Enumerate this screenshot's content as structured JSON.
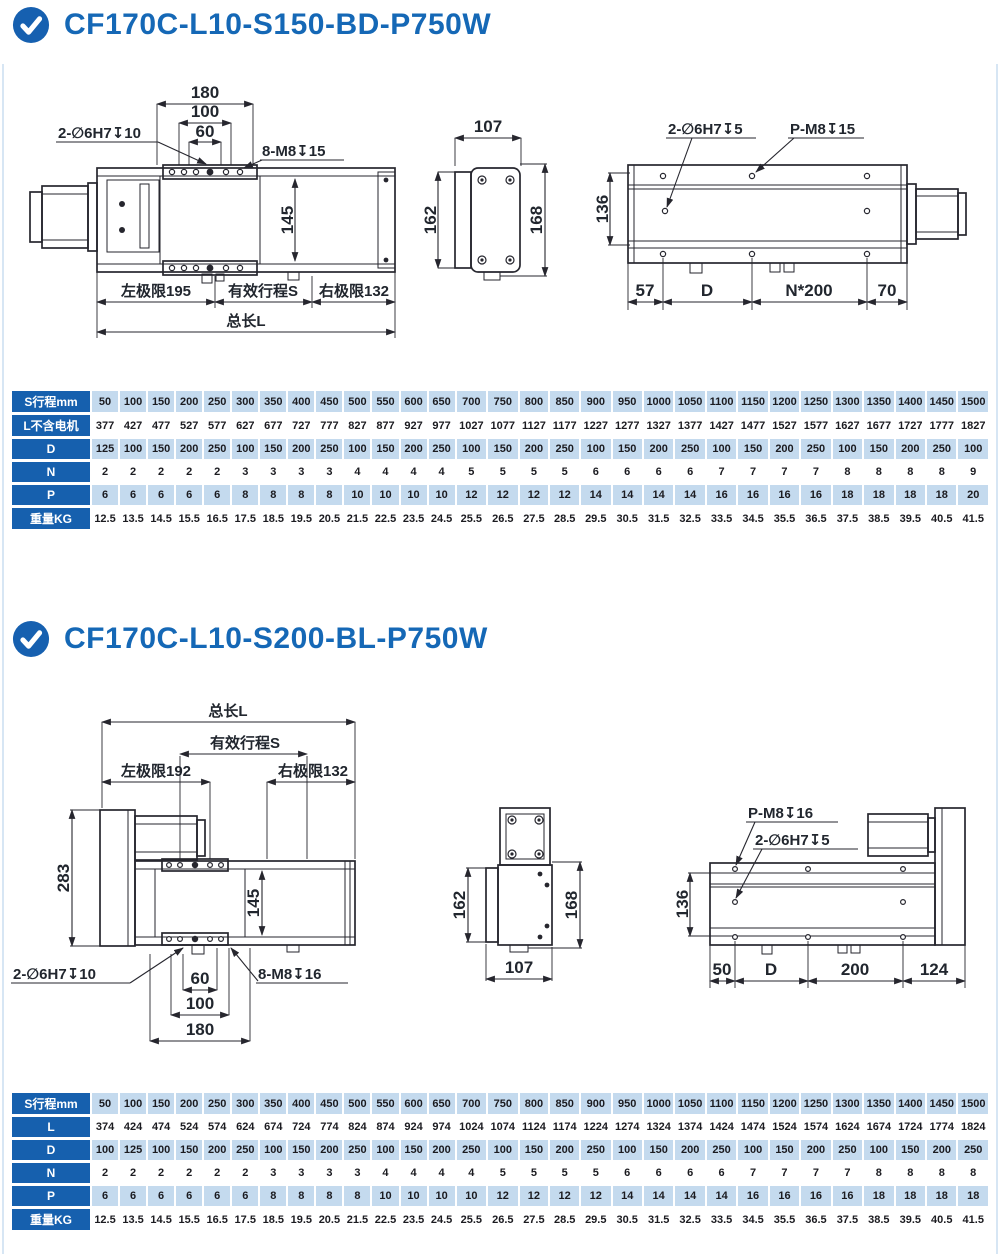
{
  "page": {
    "frame_color": "#d7e6f4",
    "accent_blue": "#1568b6",
    "table_header_blue": "#1660ae",
    "table_row_blue": "#c4daee"
  },
  "sections": [
    {
      "title": "CF170C-L10-S150-BD-P750W",
      "views": {
        "top": {
          "d180": "180",
          "d100": "100",
          "d60": "60",
          "holes": "2-∅6H7↧10",
          "screws": "8-M8↧15",
          "d145": "145",
          "left": "左极限195",
          "stroke": "有效行程S",
          "right": "右极限132",
          "total": "总长L"
        },
        "side": {
          "w": "107",
          "hl": "162",
          "hr": "168"
        },
        "bottom": {
          "holes": "2-∅6H7↧5",
          "screws": "P-M8↧15",
          "h": "136",
          "c1": "57",
          "c2": "D",
          "c3": "N*200",
          "c4": "70"
        }
      },
      "table": {
        "rows": [
          {
            "header": "S行程mm",
            "values": [
              "50",
              "100",
              "150",
              "200",
              "250",
              "300",
              "350",
              "400",
              "450",
              "500",
              "550",
              "600",
              "650",
              "700",
              "750",
              "800",
              "850",
              "900",
              "950",
              "1000",
              "1050",
              "1100",
              "1150",
              "1200",
              "1250",
              "1300",
              "1350",
              "1400",
              "1450",
              "1500"
            ]
          },
          {
            "header": "L不含电机",
            "values": [
              "377",
              "427",
              "477",
              "527",
              "577",
              "627",
              "677",
              "727",
              "777",
              "827",
              "877",
              "927",
              "977",
              "1027",
              "1077",
              "1127",
              "1177",
              "1227",
              "1277",
              "1327",
              "1377",
              "1427",
              "1477",
              "1527",
              "1577",
              "1627",
              "1677",
              "1727",
              "1777",
              "1827"
            ]
          },
          {
            "header": "D",
            "values": [
              "125",
              "100",
              "150",
              "200",
              "250",
              "100",
              "150",
              "200",
              "250",
              "100",
              "150",
              "200",
              "250",
              "100",
              "150",
              "200",
              "250",
              "100",
              "150",
              "200",
              "250",
              "100",
              "150",
              "200",
              "250",
              "100",
              "150",
              "200",
              "250",
              "100"
            ]
          },
          {
            "header": "N",
            "values": [
              "2",
              "2",
              "2",
              "2",
              "2",
              "3",
              "3",
              "3",
              "3",
              "4",
              "4",
              "4",
              "4",
              "5",
              "5",
              "5",
              "5",
              "6",
              "6",
              "6",
              "6",
              "7",
              "7",
              "7",
              "7",
              "8",
              "8",
              "8",
              "8",
              "9"
            ]
          },
          {
            "header": "P",
            "values": [
              "6",
              "6",
              "6",
              "6",
              "6",
              "8",
              "8",
              "8",
              "8",
              "10",
              "10",
              "10",
              "10",
              "12",
              "12",
              "12",
              "12",
              "14",
              "14",
              "14",
              "14",
              "16",
              "16",
              "16",
              "16",
              "18",
              "18",
              "18",
              "18",
              "20"
            ]
          },
          {
            "header": "重量KG",
            "values": [
              "12.5",
              "13.5",
              "14.5",
              "15.5",
              "16.5",
              "17.5",
              "18.5",
              "19.5",
              "20.5",
              "21.5",
              "22.5",
              "23.5",
              "24.5",
              "25.5",
              "26.5",
              "27.5",
              "28.5",
              "29.5",
              "30.5",
              "31.5",
              "32.5",
              "33.5",
              "34.5",
              "35.5",
              "36.5",
              "37.5",
              "38.5",
              "39.5",
              "40.5",
              "41.5"
            ]
          }
        ]
      }
    },
    {
      "title": "CF170C-L10-S200-BL-P750W",
      "views": {
        "top": {
          "total": "总长L",
          "stroke": "有效行程S",
          "left": "左极限192",
          "right": "右极限132",
          "d283": "283",
          "d145": "145",
          "holes": "2-∅6H7↧10",
          "screws": "8-M8↧16",
          "d60": "60",
          "d100": "100",
          "d180": "180"
        },
        "side": {
          "hl": "162",
          "hr": "168",
          "w": "107"
        },
        "bottom": {
          "screws": "P-M8↧16",
          "holes": "2-∅6H7↧5",
          "h": "136",
          "c1": "50",
          "c2": "D",
          "c3": "200",
          "c4": "124"
        }
      },
      "table": {
        "rows": [
          {
            "header": "S行程mm",
            "values": [
              "50",
              "100",
              "150",
              "200",
              "250",
              "300",
              "350",
              "400",
              "450",
              "500",
              "550",
              "600",
              "650",
              "700",
              "750",
              "800",
              "850",
              "900",
              "950",
              "1000",
              "1050",
              "1100",
              "1150",
              "1200",
              "1250",
              "1300",
              "1350",
              "1400",
              "1450",
              "1500"
            ]
          },
          {
            "header": "L",
            "values": [
              "374",
              "424",
              "474",
              "524",
              "574",
              "624",
              "674",
              "724",
              "774",
              "824",
              "874",
              "924",
              "974",
              "1024",
              "1074",
              "1124",
              "1174",
              "1224",
              "1274",
              "1324",
              "1374",
              "1424",
              "1474",
              "1524",
              "1574",
              "1624",
              "1674",
              "1724",
              "1774",
              "1824"
            ]
          },
          {
            "header": "D",
            "values": [
              "100",
              "125",
              "100",
              "150",
              "200",
              "250",
              "100",
              "150",
              "200",
              "250",
              "100",
              "150",
              "200",
              "250",
              "100",
              "150",
              "200",
              "250",
              "100",
              "150",
              "200",
              "250",
              "100",
              "150",
              "200",
              "250",
              "100",
              "150",
              "200",
              "250"
            ]
          },
          {
            "header": "N",
            "values": [
              "2",
              "2",
              "2",
              "2",
              "2",
              "2",
              "3",
              "3",
              "3",
              "3",
              "4",
              "4",
              "4",
              "4",
              "5",
              "5",
              "5",
              "5",
              "6",
              "6",
              "6",
              "6",
              "7",
              "7",
              "7",
              "7",
              "8",
              "8",
              "8",
              "8"
            ]
          },
          {
            "header": "P",
            "values": [
              "6",
              "6",
              "6",
              "6",
              "6",
              "6",
              "8",
              "8",
              "8",
              "8",
              "10",
              "10",
              "10",
              "10",
              "12",
              "12",
              "12",
              "12",
              "14",
              "14",
              "14",
              "14",
              "16",
              "16",
              "16",
              "16",
              "18",
              "18",
              "18",
              "18"
            ]
          },
          {
            "header": "重量KG",
            "values": [
              "12.5",
              "13.5",
              "14.5",
              "15.5",
              "16.5",
              "17.5",
              "18.5",
              "19.5",
              "20.5",
              "21.5",
              "22.5",
              "23.5",
              "24.5",
              "25.5",
              "26.5",
              "27.5",
              "28.5",
              "29.5",
              "30.5",
              "31.5",
              "32.5",
              "33.5",
              "34.5",
              "35.5",
              "36.5",
              "37.5",
              "38.5",
              "39.5",
              "40.5",
              "41.5"
            ]
          }
        ]
      }
    }
  ]
}
